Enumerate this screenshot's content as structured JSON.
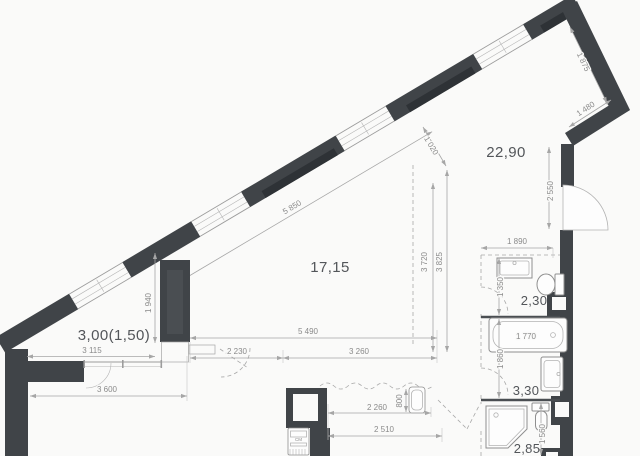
{
  "plan": {
    "colors": {
      "bg": "#fafaf9",
      "wall": "#404448",
      "wallDark": "#2e3236",
      "wallLight": "#4a4e52",
      "line": "#9c9c9c",
      "dim": "#8a8a8a",
      "label": "#53565a"
    },
    "rooms": [
      {
        "name": "living-area",
        "label": "22,90"
      },
      {
        "name": "main-room",
        "label": "17,15"
      },
      {
        "name": "balcony",
        "label": "3,00(1,50)"
      },
      {
        "name": "bathroom-top",
        "label": "2,30"
      },
      {
        "name": "bathroom-mid",
        "label": "3,30"
      },
      {
        "name": "bathroom-bottom",
        "label": "2,85"
      }
    ],
    "dimensions": {
      "w1875": "1 875",
      "w1480": "1 480",
      "w2550": "2 550",
      "w1890": "1 890",
      "w1350": "1 350",
      "w1770": "1 770",
      "w1860": "1 860",
      "w1560": "1 560",
      "w5850": "5 850",
      "w1020": "1 020",
      "w3720": "3 720",
      "w3825": "3 825",
      "w5490": "5 490",
      "w2230": "2 230",
      "w3260": "3 260",
      "w1940": "1 940",
      "w3115": "3 115",
      "w3600": "3 600",
      "w2260": "2 260",
      "w800": "800",
      "w2510": "2 510"
    },
    "appliance_label": "СМ",
    "fixtures": [
      "washbasin",
      "toilet",
      "bathtub",
      "washbasin",
      "shower-cabin",
      "toilet",
      "kitchen-sink",
      "washing-machine",
      "vent-shaft",
      "vent-duct"
    ]
  }
}
